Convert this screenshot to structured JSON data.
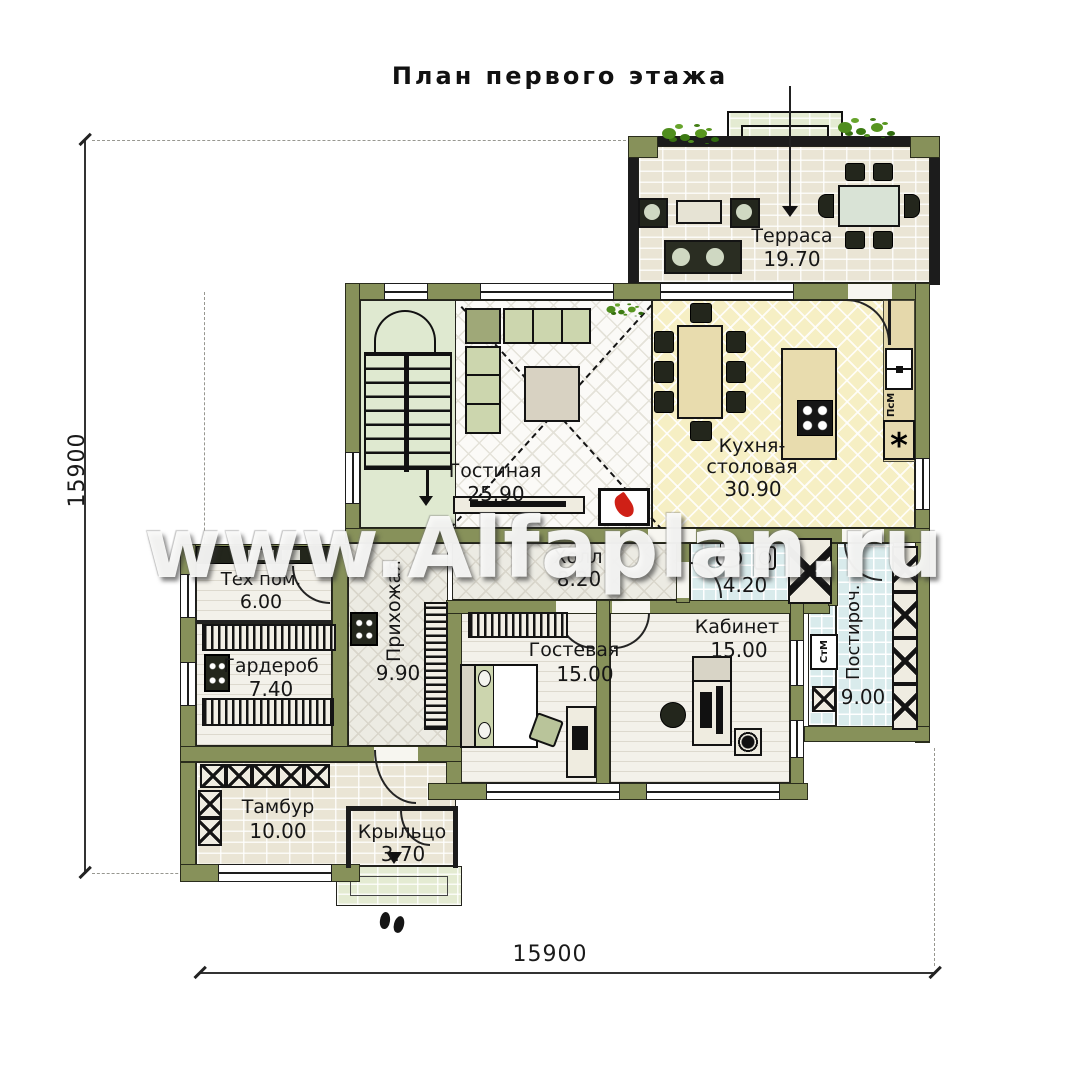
{
  "title": "План первого этажа",
  "watermark": "www.Alfaplan.ru",
  "dimensions": {
    "left": "15900",
    "bottom": "15900"
  },
  "rooms": {
    "terrace": {
      "name": "Терраса",
      "area": "19.70"
    },
    "living": {
      "name": "Гостиная",
      "area": "25.90"
    },
    "kitchen": {
      "name": "Кухня-столовая",
      "area": "30.90"
    },
    "tech": {
      "name": "Тех пом.",
      "area": "6.00"
    },
    "wardrobe": {
      "name": "Гардероб",
      "area": "7.40"
    },
    "entry": {
      "name": "Прихожая",
      "area": "9.90"
    },
    "hall": {
      "name": "Холл",
      "area": "8.20"
    },
    "bath": {
      "name": "",
      "area": "4.20"
    },
    "guest": {
      "name": "Гостевая",
      "area": "15.00"
    },
    "office": {
      "name": "Кабинет",
      "area": "15.00"
    },
    "laundry": {
      "name": "Постироч.",
      "area": "9.00"
    },
    "vestibule": {
      "name": "Тамбур",
      "area": "10.00"
    },
    "porch": {
      "name": "Крыльцо",
      "area": "3.70"
    }
  },
  "appliances": {
    "washer": "СтМ",
    "dishwasher": "ПсМ",
    "fridge": "*"
  },
  "colors": {
    "wall": "#87915a",
    "kitchen_floor": "#f6efc4",
    "wet_floor": "#d9ebec",
    "plant": "#4f8d1e",
    "flame": "#cf2016"
  }
}
